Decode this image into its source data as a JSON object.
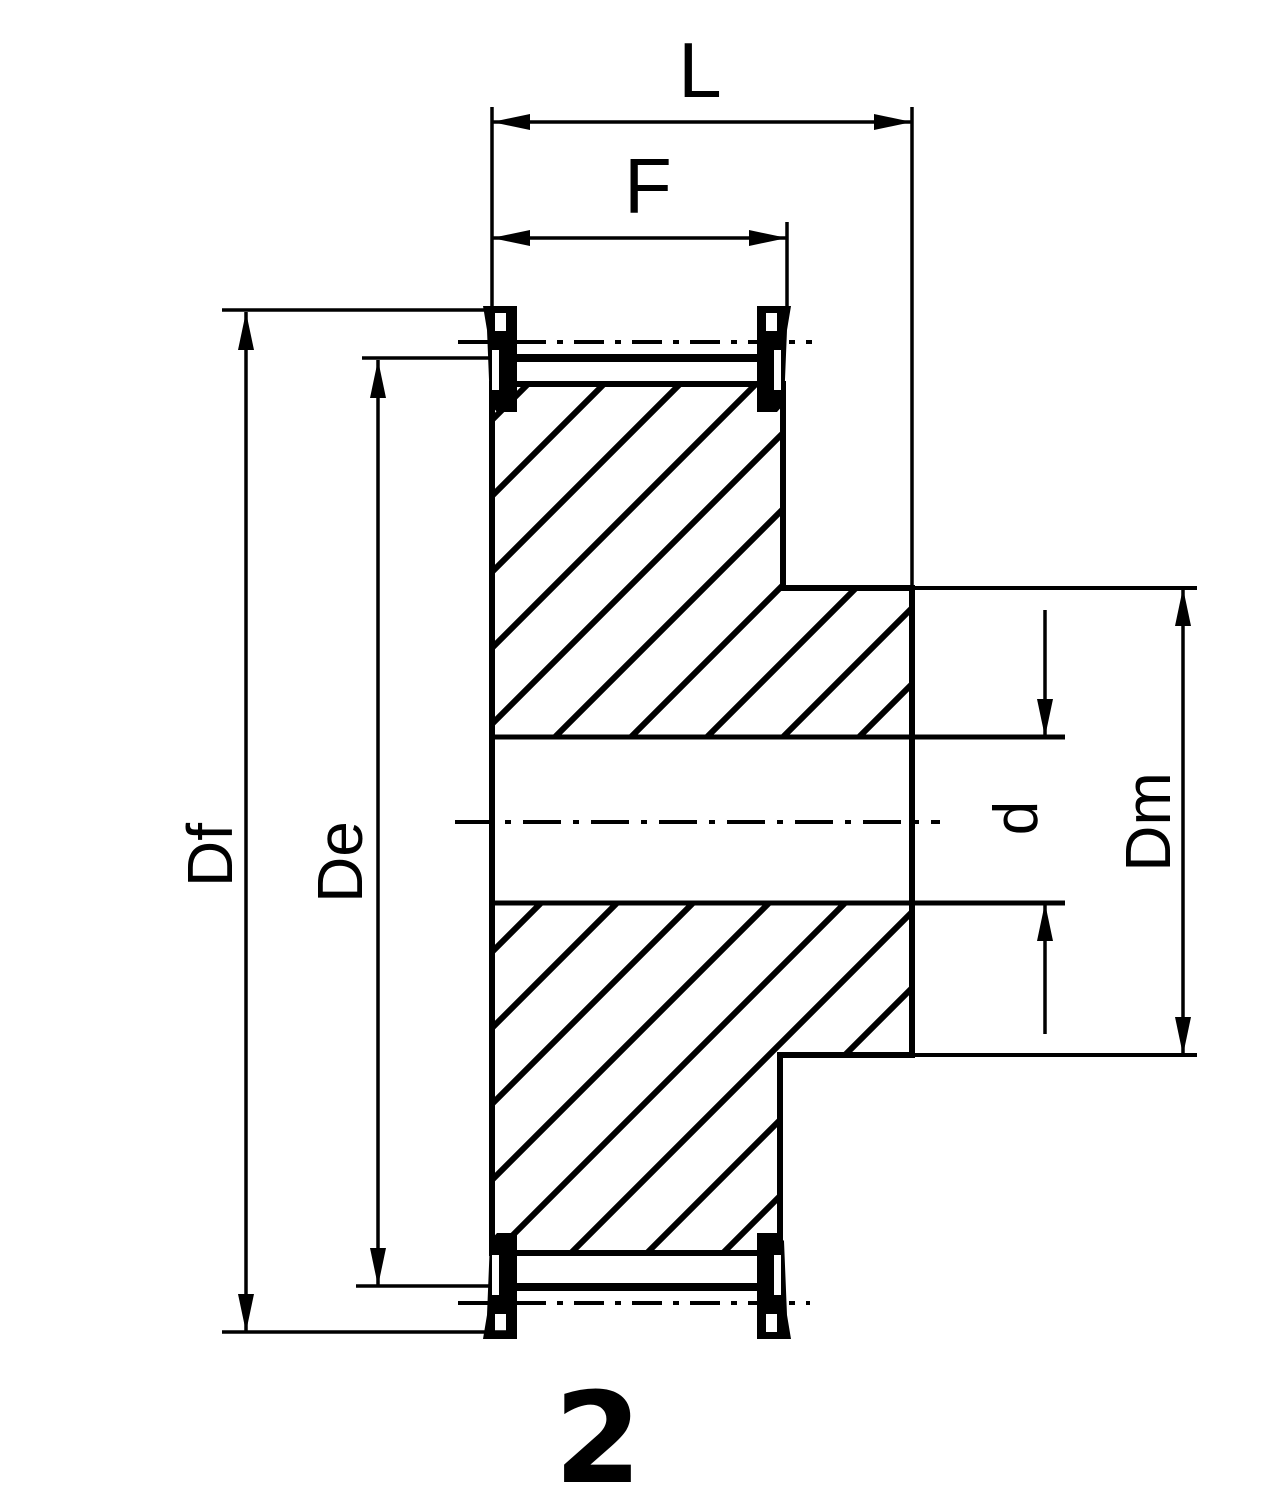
{
  "figure": {
    "number": "2"
  },
  "dimensions": {
    "L": {
      "label": "L"
    },
    "F": {
      "label": "F"
    },
    "Df": {
      "label": "Df"
    },
    "De": {
      "label": "De"
    },
    "d": {
      "label": "d"
    },
    "Dm": {
      "label": "Dm"
    }
  },
  "colors": {
    "ink": "#000000",
    "paper": "#ffffff"
  }
}
